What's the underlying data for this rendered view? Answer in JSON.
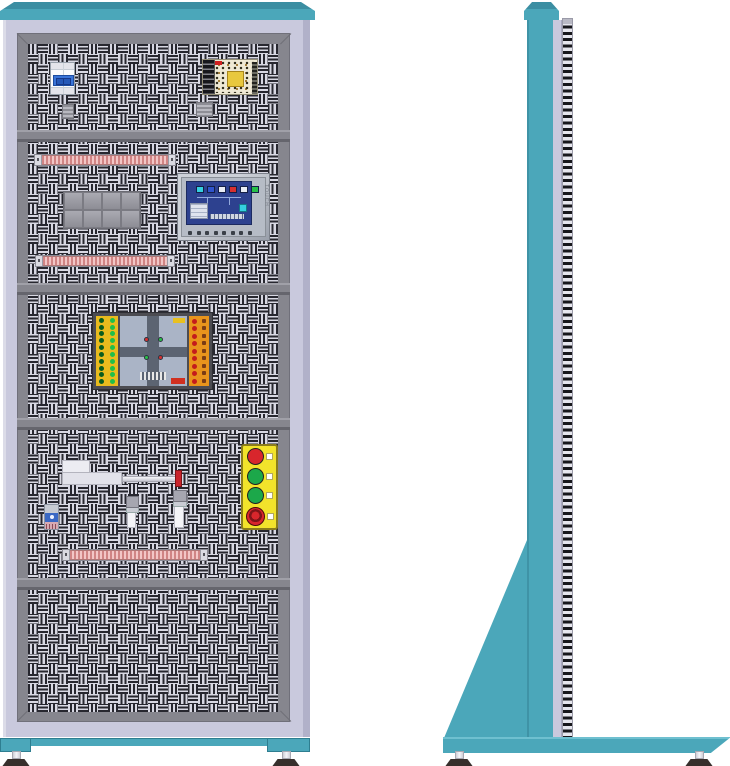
{
  "scene": {
    "title": "Electrical training cabinet technical drawing",
    "views": {
      "front": "front view",
      "side": "side view"
    }
  },
  "palette": {
    "teal": "#4ba7ba",
    "teal_dark": "#3b8ea2",
    "lavender": "#c9c9dd",
    "lavender_dark": "#b1b1c9",
    "frame_gray": "#86868e",
    "frame_dark": "#65656d",
    "panel_bg": "#d8d8e3",
    "hole": "#27272f",
    "screen_blue": "#2d418f",
    "station_yellow": "#f2e32b",
    "toggle_blue": "#3a74d8",
    "xfmr_yellow": "#e8c83e",
    "tooth_pink": "#d08484",
    "tip_red": "#c8232b"
  },
  "components": {
    "circuit_breaker": {
      "name": "2-pole miniature circuit breaker"
    },
    "power_supply": {
      "name": "open-frame switching power supply"
    },
    "hmi": {
      "name": "touch panel HMI",
      "side_label": "TOUCH",
      "key_count": 8,
      "chip_colors": [
        "#35cfe0",
        "#2f54cc",
        "#e8ecf4",
        "#d83030",
        "#e8ecf4",
        "#28c048"
      ]
    },
    "relay_block": {
      "name": "contactor group",
      "rows": 2,
      "cols": 4
    },
    "traffic_board": {
      "name": "traffic-light trainer board",
      "left_rows": 10,
      "right_rows": 9,
      "signal_colors": [
        "#d83030",
        "#28c048",
        "#28c048",
        "#d83030"
      ],
      "left_panel_color": "#e9bb1e",
      "right_panel_color": "#e8941c"
    },
    "terminal_rails": {
      "name": "terminal strip",
      "count": 3
    },
    "cylinder": {
      "name": "pneumatic cylinder with rod"
    },
    "sensors": {
      "name": "position sensor",
      "count": 2
    },
    "button_station": {
      "name": "pushbutton station",
      "buttons": [
        {
          "kind": "pushbutton",
          "color": "#d8262c"
        },
        {
          "kind": "pushbutton",
          "color": "#1ca84a"
        },
        {
          "kind": "pushbutton",
          "color": "#1ca84a"
        },
        {
          "kind": "emergency-stop",
          "color": "#d8262c",
          "ring": "#7e1418"
        }
      ]
    }
  }
}
